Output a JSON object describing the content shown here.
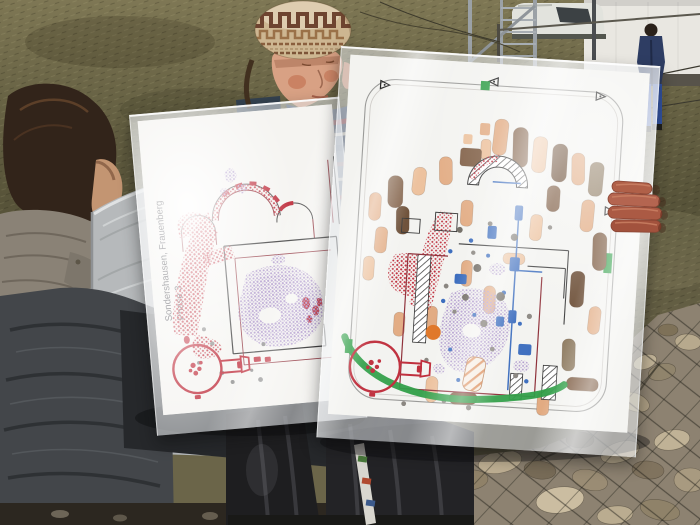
{
  "plans": {
    "left": {
      "title": "Sondershausen, Frauenberg",
      "phase": "Phase 3"
    },
    "right": {}
  },
  "colors": {
    "plan_paper": "#f5f4f1",
    "masonry_red": "#bf2e3c",
    "outline_dark_red": "#8e2f38",
    "stipple_purple": "#b29cce",
    "grave_brown": "#7c5a40",
    "grave_brown_dark": "#6a4c34",
    "grave_gray_brown": "#8f7c62",
    "grave_tan": "#e2ab82",
    "grave_tan_light": "#ecc09b",
    "accent_blue": "#3c6dbe",
    "accent_green": "#2f9e47",
    "accent_orange": "#e0782a",
    "plan_line_gray": "#9a9a98"
  }
}
